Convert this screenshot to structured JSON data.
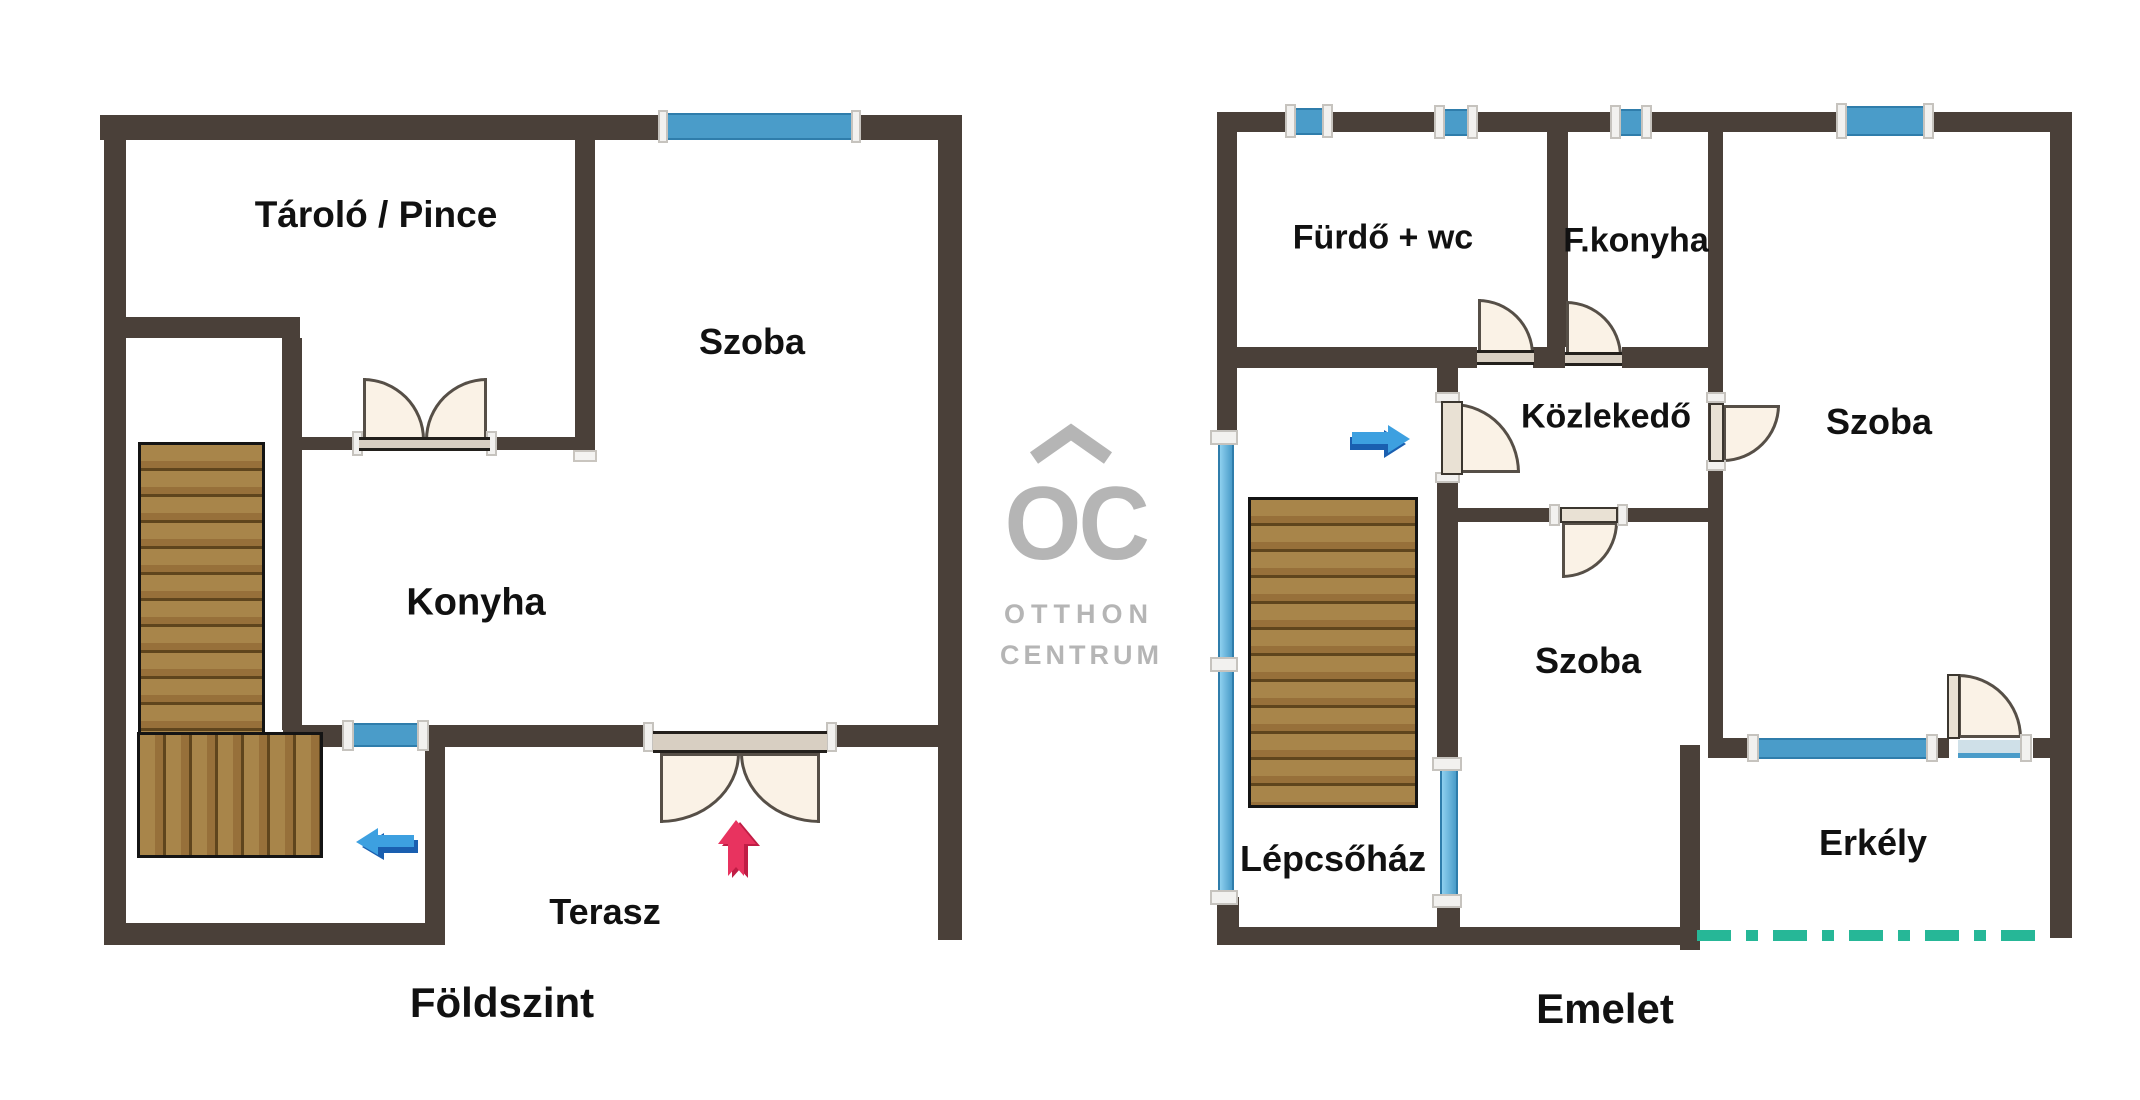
{
  "brand": {
    "monogram": "OC",
    "name_line1": "OTTHON",
    "name_line2": "CENTRUM"
  },
  "floor_plans": {
    "ground": {
      "title": "Földszint",
      "rooms": {
        "storage": "Tároló / Pince",
        "room": "Szoba",
        "kitchen": "Konyha",
        "terrace": "Terasz"
      }
    },
    "upper": {
      "title": "Emelet",
      "rooms": {
        "bathroom": "Fürdő + wc",
        "kitchenette": "F.konyha",
        "hall": "Közlekedő",
        "room_right": "Szoba",
        "room_middle": "Szoba",
        "stairwell": "Lépcsőház",
        "balcony": "Erkély"
      }
    }
  },
  "colors": {
    "wall": "#4a4039",
    "window_blue": "#4a9cc9",
    "window_light_blue": "#8ed0ef",
    "door_leaf": "#faf2e6",
    "door_sill": "#d8cfc2",
    "wood_light": "#a8854a",
    "wood_dark": "#5f451d",
    "arrow_blue_light": "#3da0e0",
    "arrow_blue_dark": "#1a5fb0",
    "arrow_pink": "#e8335f",
    "arrow_pink_dark": "#c01d45",
    "balcony_dash_teal": "#26b797",
    "logo_gray": "#b5b5b5",
    "label_black": "#111111"
  }
}
